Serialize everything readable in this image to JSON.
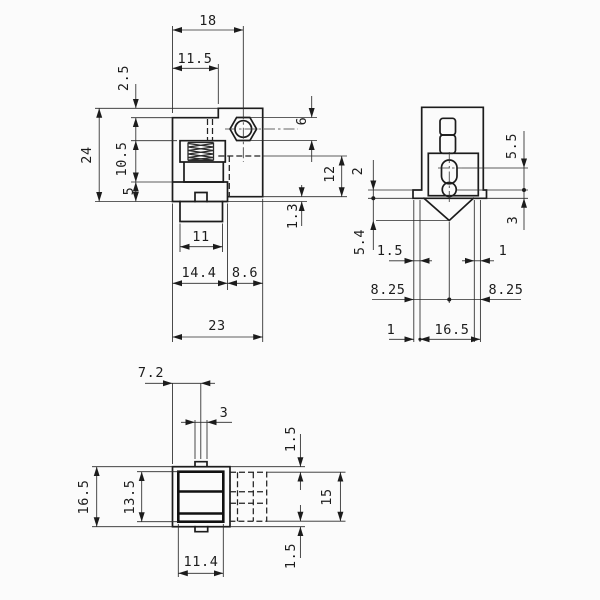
{
  "drawing": {
    "type": "mechanical-part-3-view-dimensioned-drawing",
    "background_color": "#fbfbfb",
    "line_color": "#1c1c1c",
    "front": {
      "dims": {
        "top_width": "18",
        "step_width": "11.5",
        "step_height": "2.5",
        "overall_height": "24",
        "spring_section_height": "10.5",
        "base_section_height": "5",
        "nut_size": "6",
        "side_recess_height": "12",
        "bottom_lip": "1.3",
        "terminal_width": "11",
        "left_section_width": "14.4",
        "right_section_width": "8.6",
        "overall_width": "23"
      }
    },
    "side": {
      "dims": {
        "hole_spacing": "5.5",
        "hole_to_bottom": "3",
        "step_height": "2",
        "pin_length": "5.4",
        "left_foot_width": "1.5",
        "right_foot_width": "1",
        "center_left": "8.25",
        "center_right": "8.25",
        "base_offset": "1",
        "body_width": "16.5"
      }
    },
    "bottom": {
      "dims": {
        "tab_center_offset": "7.2",
        "tab_width": "3",
        "overall_height": "16.5",
        "contact_height": "13.5",
        "contact_width": "11.4",
        "top_clearance": "1.5",
        "cavity_height": "15",
        "bottom_clearance": "1.5"
      }
    }
  }
}
